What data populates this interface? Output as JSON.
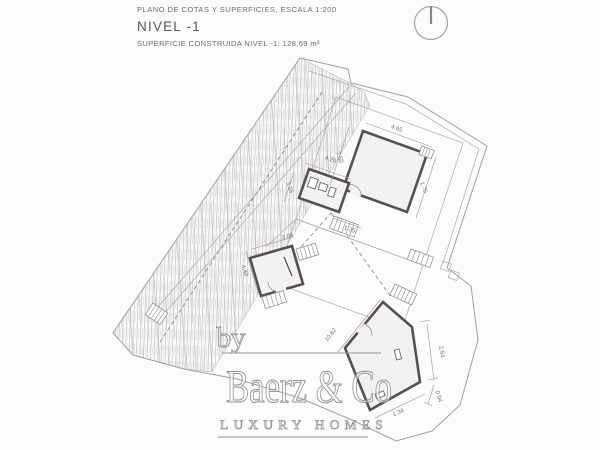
{
  "header": {
    "plan_title": "PLANO DE COTAS Y SUPERFICIES, ESCALA 1:200",
    "level_label": "NIVEL -1",
    "area_label": "SUPERFICIE CONSTRUIDA NIVEL -1: 128,69 m²"
  },
  "icons": {
    "north": "north-orientation-circle"
  },
  "plan": {
    "scale": "1:200",
    "level": "-1",
    "built_area_m2": "128,69",
    "dimensions": [
      "4.65",
      "7.50",
      "1.75",
      "4.20",
      "3.26",
      "1.25",
      "3.05",
      "4.40",
      "10.82",
      "2.54",
      "0.94",
      "1.34"
    ]
  },
  "watermark": {
    "prefix": "by",
    "brand": "Baerz & Co",
    "tagline": "LUXURY HOMES"
  },
  "colors": {
    "paper": "#fcfbf9",
    "thin_line": "#a3a09b",
    "wall": "#55524e",
    "hatch": "#c8c5c0",
    "dimension_text": "#78756f",
    "header_text": "#6f6d6a",
    "watermark": "#939390"
  }
}
